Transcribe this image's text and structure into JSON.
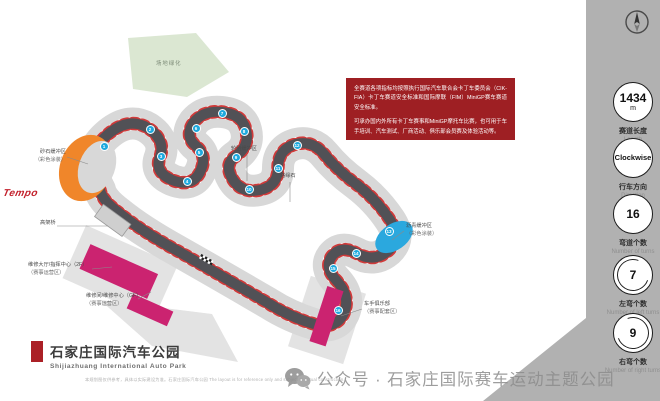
{
  "colors": {
    "accent_red": "#9e1f23",
    "sidebar_gray": "#b1b1b1",
    "track_asphalt": "#515156",
    "runoff_gray": "#d8d8d8",
    "curb_red": "#cf3a3a",
    "gravel_orange": "#f0862a",
    "painted_blue": "#2ba8de",
    "building_pink": "#cb2370",
    "green_area": "#dbe7d2",
    "turn_marker_blue": "#1ea9de"
  },
  "brand": {
    "logo_text": "Tempo"
  },
  "info_box": {
    "paragraph1": "全赛道各项指标均按照执行国际汽车联合会卡丁车委员会（CIK-FIA）卡丁车赛道安全标准和国际摩联（FIM）MiniGP赛车赛道安全标准。",
    "paragraph2": "可承办国内外所有卡丁车赛事和MiniGP摩托车比赛，也可用于车手培训、汽车测试、厂商活动、俱乐部会员赛及体验活动等。"
  },
  "title_block": {
    "zh": "石家庄国际汽车公园",
    "en": "Shijiazhuang International Auto Park"
  },
  "sidebar": {
    "stats": [
      {
        "value1": "1434",
        "value2": "m",
        "zh": "赛道长度",
        "en": "Length",
        "cy": 102,
        "arrow": ""
      },
      {
        "value1": "Clockwise",
        "value2": "",
        "zh": "行车方向",
        "en": "Direction",
        "cy": 158,
        "arrow": "",
        "small": true
      },
      {
        "value1": "16",
        "value2": "",
        "zh": "弯道个数",
        "en": "Number of turns",
        "cy": 214,
        "arrow": ""
      },
      {
        "value1": "7",
        "value2": "",
        "zh": "左弯个数",
        "en": "Number of left turns",
        "cy": 275,
        "arrow": "ccw"
      },
      {
        "value1": "9",
        "value2": "",
        "zh": "右弯个数",
        "en": "Number of right turns",
        "cy": 333,
        "arrow": "cw"
      }
    ]
  },
  "map": {
    "green_area_label": "场地绿化",
    "labels": [
      {
        "zh": "砂石缓冲区",
        "sub": "（彩色涂装）",
        "x": 30,
        "y": 152,
        "align": "right",
        "w": 36
      },
      {
        "zh": "轮胎缓冲区",
        "sub": "",
        "x": 231,
        "y": 149,
        "align": "left",
        "w": 0
      },
      {
        "zh": "路缘石",
        "sub": "",
        "x": 280,
        "y": 176,
        "align": "left",
        "w": 0
      },
      {
        "zh": "沥青缓冲区",
        "sub": "（彩色涂装）",
        "x": 406,
        "y": 226,
        "align": "left",
        "w": 0
      },
      {
        "zh": "高架桥",
        "sub": "",
        "x": 40,
        "y": 223,
        "align": "left",
        "w": 0
      },
      {
        "zh": "维修大厅/指挥中心（2F）",
        "sub": "（赛事运营区）",
        "x": 28,
        "y": 265,
        "align": "left",
        "w": 0
      },
      {
        "zh": "维修间/维修中心（GF）",
        "sub": "（赛事运营区）",
        "x": 86,
        "y": 296,
        "align": "left",
        "w": 0
      },
      {
        "zh": "车手俱乐部",
        "sub": "（赛事配套区）",
        "x": 364,
        "y": 304,
        "align": "left",
        "w": 0
      }
    ],
    "turns": [
      {
        "n": 1,
        "x": 104,
        "y": 146
      },
      {
        "n": 2,
        "x": 150,
        "y": 129
      },
      {
        "n": 3,
        "x": 161,
        "y": 156
      },
      {
        "n": 4,
        "x": 187,
        "y": 181
      },
      {
        "n": 5,
        "x": 199,
        "y": 152
      },
      {
        "n": 6,
        "x": 196,
        "y": 128
      },
      {
        "n": 7,
        "x": 222,
        "y": 113
      },
      {
        "n": 8,
        "x": 244,
        "y": 131
      },
      {
        "n": 9,
        "x": 236,
        "y": 157
      },
      {
        "n": 10,
        "x": 249,
        "y": 189
      },
      {
        "n": 11,
        "x": 278,
        "y": 168
      },
      {
        "n": 12,
        "x": 297,
        "y": 145
      },
      {
        "n": 13,
        "x": 389,
        "y": 231
      },
      {
        "n": 14,
        "x": 356,
        "y": 253
      },
      {
        "n": 15,
        "x": 333,
        "y": 268
      },
      {
        "n": 16,
        "x": 338,
        "y": 310
      }
    ]
  },
  "watermark": {
    "text": "公众号 · 石家庄国际赛车运动主题公园"
  },
  "fine_print": "本规划图仅供参考，具体以实际建设为准。石家庄国际汽车公园  The layout is for reference only and subject to actual construction."
}
